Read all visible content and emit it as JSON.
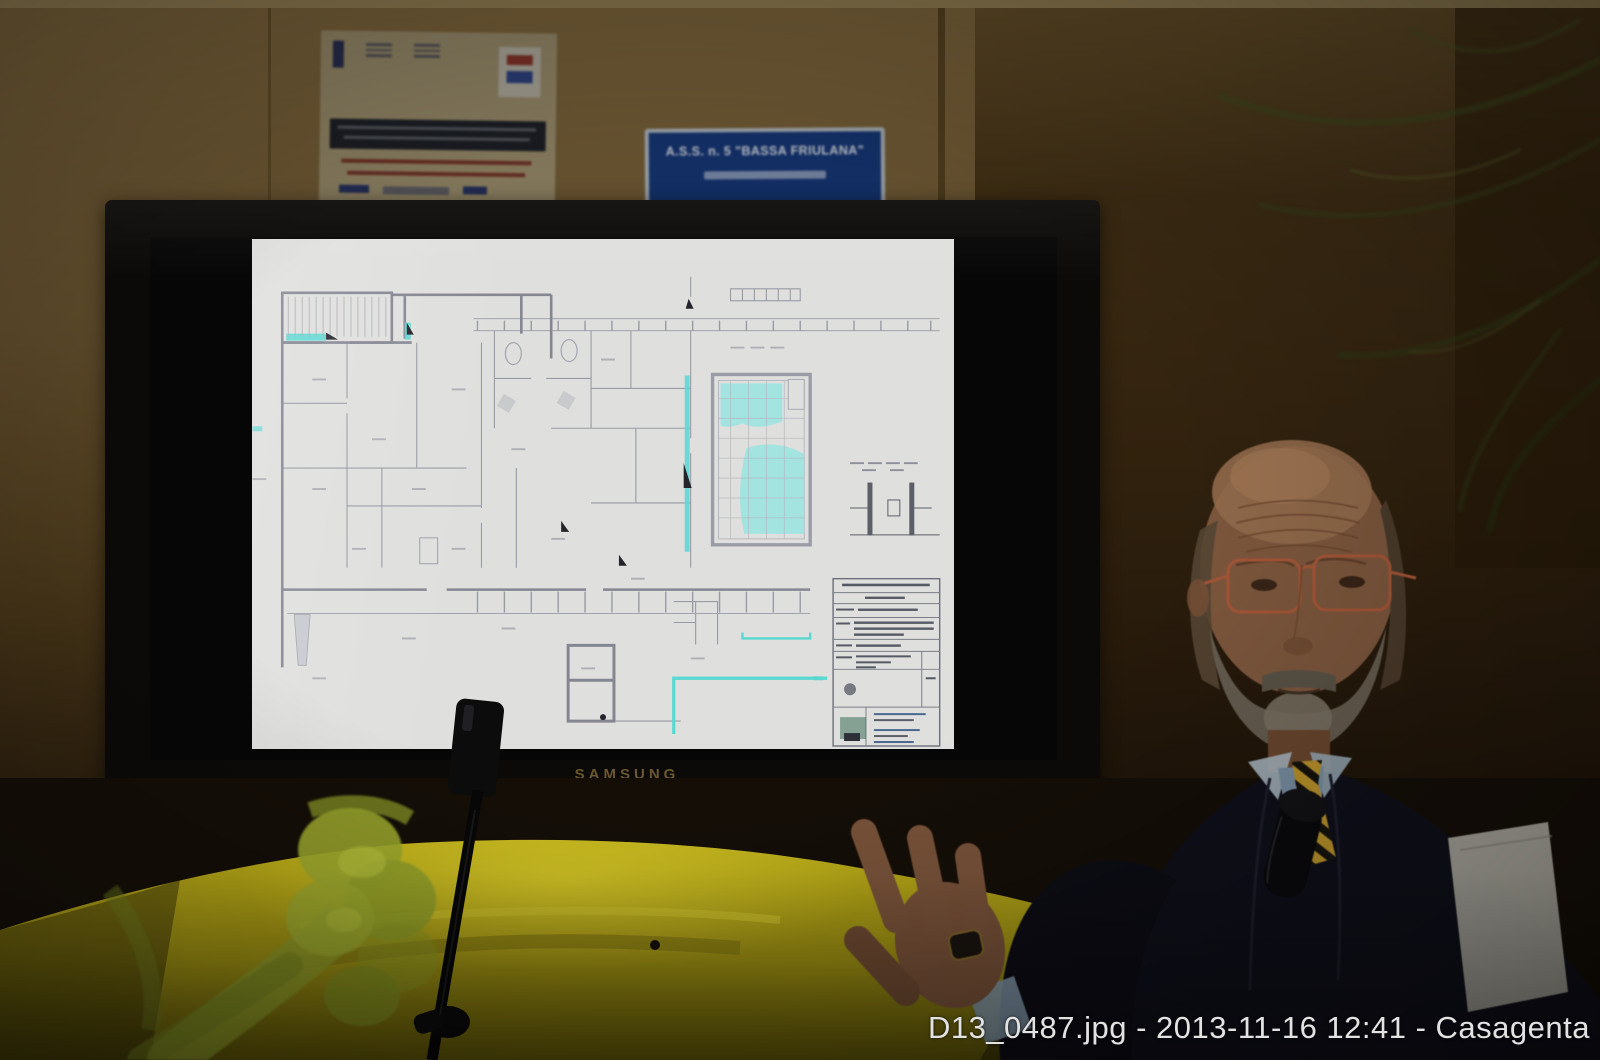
{
  "caption": "D13_0487.jpg - 2013-11-16 12:41 - Casagenta",
  "tv": {
    "brand": "SAMSUNG"
  },
  "wall_sign": {
    "title": "A.S.S. n. 5 \"BASSA FRIULANA\""
  },
  "slide": {
    "content": "architectural-floor-plan",
    "highlight_color": "#5ad8d2",
    "line_color": "#9094a0",
    "paper_color": "#dfdfdd"
  },
  "colors": {
    "wall_left": "#5d4a2b",
    "wall_right": "#30210e",
    "tablecloth_yellow": "#b3a513",
    "mesh_green": "#94a02b",
    "sign_blue": "#17397c",
    "caption_text": "#e2e2e2"
  }
}
